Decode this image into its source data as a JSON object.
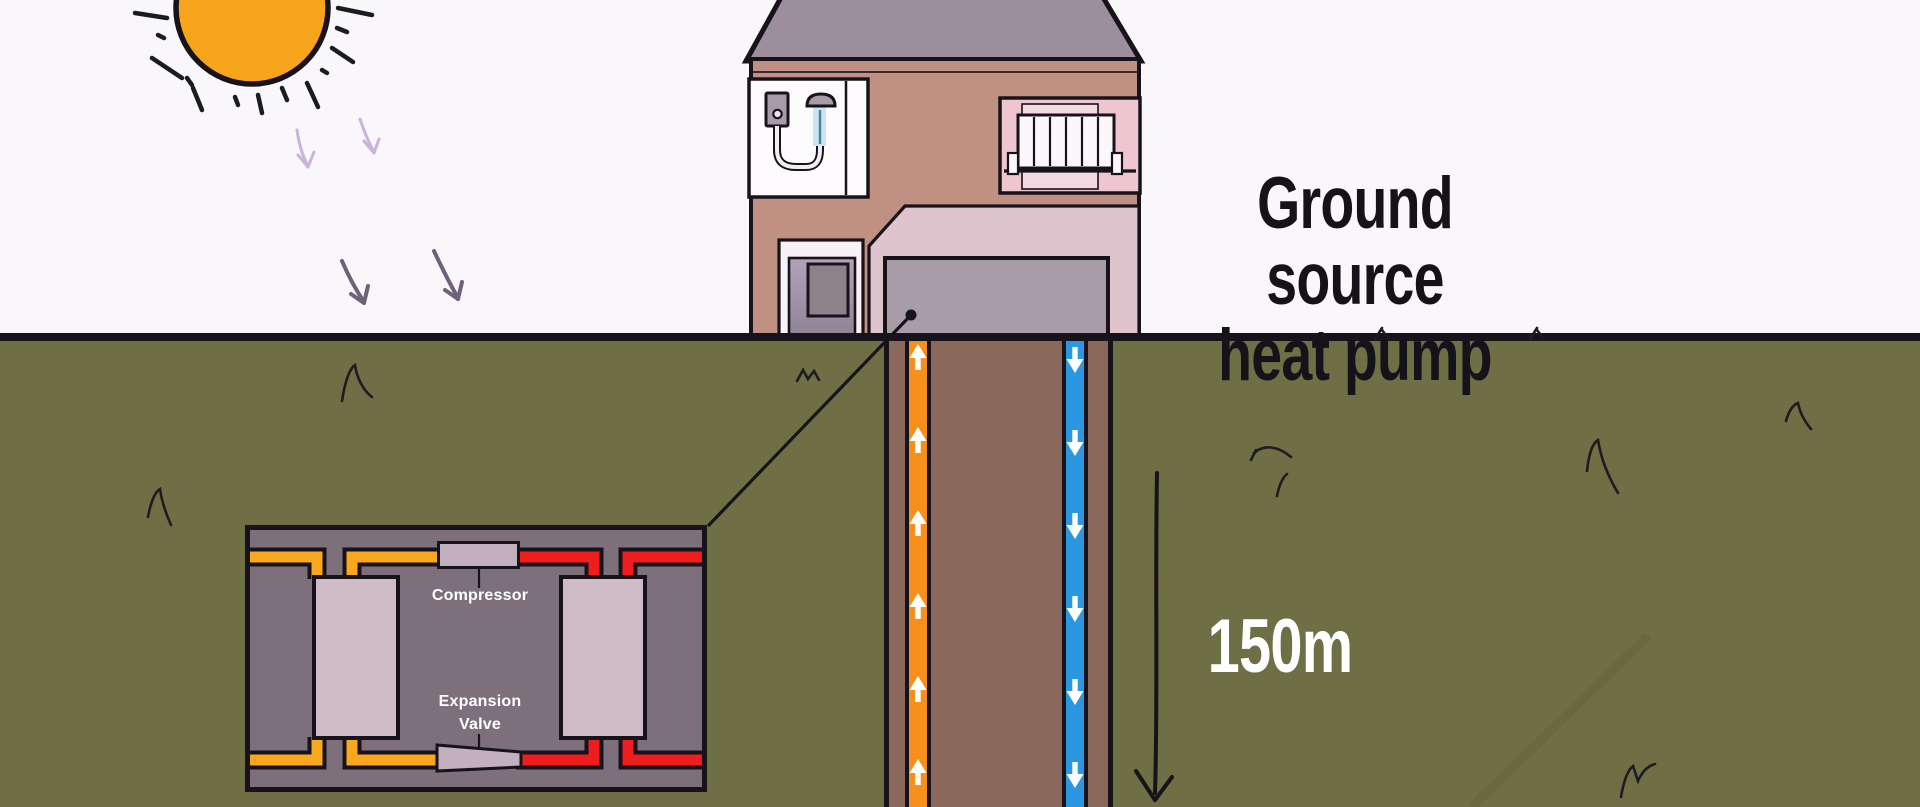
{
  "diagram": {
    "title": {
      "line1": "Ground source",
      "line2": "heat pump"
    },
    "borehole": {
      "depth_label": "150m",
      "up_pipe": {
        "direction": "up",
        "color": "#F78F1C"
      },
      "down_pipe": {
        "direction": "down",
        "color": "#2A97E0"
      }
    },
    "heat_pump_unit": {
      "compressor_label": "Compressor",
      "expansion_valve_label": [
        "Expansion",
        "Valve"
      ]
    }
  },
  "icons": {
    "sun-icon": "orange-circle-with-black-rays",
    "solar-heat-arrow-icon": "hand-drawn-downward-arrow",
    "flow-up-arrow-icon": "white-up-arrow-in-pipe",
    "flow-down-arrow-icon": "white-down-arrow-in-pipe",
    "depth-arrow-icon": "long-black-down-arrow",
    "grass-tuft-icon": "black-squiggle",
    "water-heater-icon": "wall-mounted-boiler",
    "shower-icon": "shower-head-with-water",
    "radiator-icon": "slatted-wall-radiator",
    "callout-dot-icon": "black-dot"
  },
  "colors": {
    "sky": "#FAF7FA",
    "ground_green": "#6E6F44",
    "outline_dark": "#17131A",
    "trench_brown": "#8A695C",
    "pipe_up_orange": "#F78F1C",
    "pipe_down_blue": "#2A97E0",
    "roof_gray": "#9C8E9C",
    "wall_pink": "#C09183",
    "bathroom_white": "#FDFBFD",
    "fixture_gray": "#A89BA8",
    "water_blue": "#C9E4F2",
    "water_line_teal": "#4A8391",
    "room_pink": "#EFC6D0",
    "room_panel_pink": "#F3D9E1",
    "radiator_white": "#FCF7FA",
    "cutaway_pink": "#DFC3CD",
    "slab_gray": "#A89CA7",
    "door_frame_white": "#F8F1F5",
    "door_purple": "#B3A3B9",
    "door_purple_dark": "#8F8398",
    "door_window_gray": "#8C8289",
    "box_bg": "#7D707A",
    "component_light": "#CDBCC6",
    "component_mid": "#C2B0BC",
    "loop_orange": "#F9A71E",
    "loop_red": "#F01D1F",
    "sun_orange": "#F6A41C",
    "arrow_light_purple": "#C8B3DF",
    "arrow_dark_purple": "#6E6178",
    "title_dark": "#16121A",
    "label_white": "#FFFFFF"
  }
}
